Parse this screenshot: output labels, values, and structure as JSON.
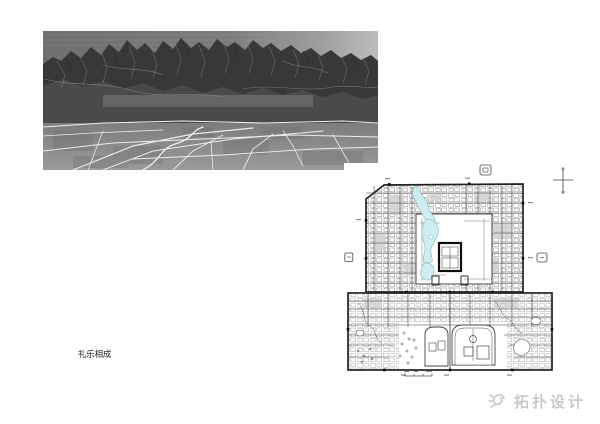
{
  "page": {
    "background": "#ffffff"
  },
  "caption": {
    "text": "礼乐相成"
  },
  "watermark": {
    "text": "拓扑设计",
    "icon": "bird-logo-icon",
    "color": "#c8c8c8"
  },
  "figures": {
    "photo": {
      "label": "aerial-photo-of-mountains-and-plain"
    },
    "map": {
      "label": "old-beijing-city-map",
      "water_color": "#cdeef0",
      "water_stroke": "#86b7bd",
      "ink_color": "#3a3a3a"
    }
  }
}
